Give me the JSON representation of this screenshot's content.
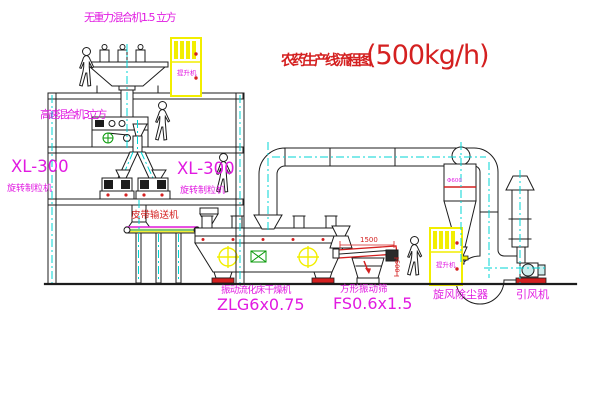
{
  "title": {
    "name": "农药生产线流程图",
    "capacity": "(500kg/h)"
  },
  "labels": {
    "top_mixer": "无重力混合机1.5 立方",
    "floor2_mixer": "高速混合机3立方",
    "granulator_left_model": "XL-300",
    "granulator_left_name": "旋转制粒机",
    "granulator_right_model": "XL-300",
    "granulator_right_name": "旋转制粒机",
    "belt_conveyor": "皮带输送机",
    "dryer_name": "振动流化床干燥机",
    "dryer_model": "ZLG6x0.75",
    "screen_name": "方形振动筛",
    "screen_model": "FS0.6x1.5",
    "cyclone": "旋风除尘器",
    "induced_draft_fan": "引风机",
    "elevator_1": "提升机",
    "elevator_2": "提升机",
    "screen_length_dim": "1500",
    "screen_height_dim": "500",
    "cyclone_dim": "Φ600"
  },
  "colors": {
    "background": "#ffffff",
    "line_black": "#1c1c1c",
    "label_magenta": "#e11ae1",
    "annotation_red": "#d42020",
    "centerline_cyan": "#00d4d4",
    "equipment_yellow": "#f2ee00",
    "accent_green": "#0a9a0a"
  }
}
